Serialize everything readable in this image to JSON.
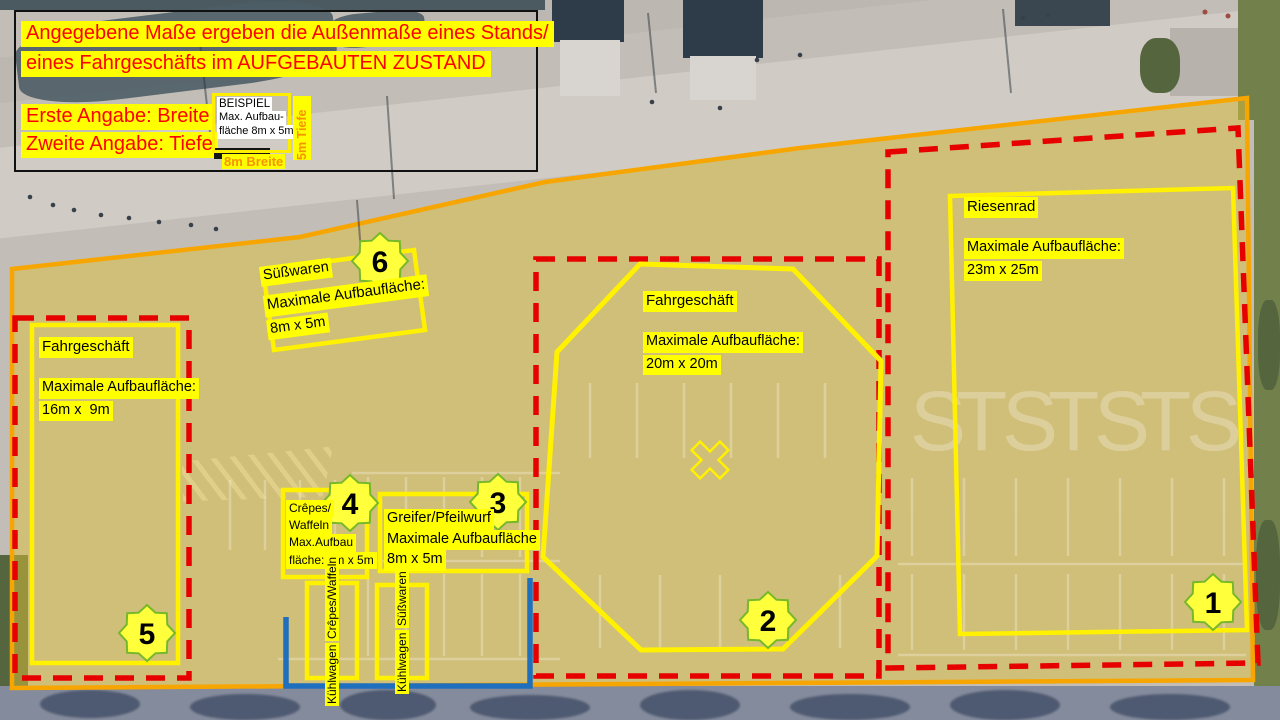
{
  "legend": {
    "title_line1": "Angegebene Maße ergeben die Außenmaße eines Stands/",
    "title_line2": "eines Fahrgeschäfts im AUFGEBAUTEN ZUSTAND",
    "note_breite": "Erste Angabe: Breite",
    "note_tiefe": "Zweite Angabe: Tiefe",
    "example": {
      "title": "BEISPIEL",
      "desc_line1": "Max. Aufbau-",
      "desc_line2": "fläche 8m x 5m",
      "depth_label": "5m Tiefe",
      "width_label": "8m Breite"
    }
  },
  "zones": [
    {
      "badge": "1",
      "name": "Riesenrad",
      "size_label": "Maximale Aufbaufläche:",
      "size": "23m x 25m"
    },
    {
      "badge": "2",
      "name": "Fahrgeschäft",
      "size_label": "Maximale Aufbaufläche:",
      "size": "20m x 20m"
    },
    {
      "badge": "3",
      "name": "Greifer/Pfeilwurf",
      "size_label": "Maximale Aufbaufläche",
      "size": "8m x 5m"
    },
    {
      "badge": "4",
      "name_line1": "Crêpes/",
      "name_line2": "Waffeln",
      "size_label": "Max.Aufbau",
      "size_line2": "fläche: 5m x 5m"
    },
    {
      "badge": "5",
      "name": "Fahrgeschäft",
      "size_label": "Maximale Aufbaufläche:",
      "size": "16m x  9m"
    },
    {
      "badge": "6",
      "name": "Süßwaren",
      "size_label": "Maximale Aufbaufläche:",
      "size": "8m x 5m"
    }
  ],
  "coolers": [
    {
      "line1": "Kühlwagen",
      "line2": "Crêpes/Waffeln"
    },
    {
      "line1": "Kühlwagen",
      "line2": "Süßwaren"
    }
  ],
  "pavement_marks": {
    "letters": [
      "S",
      "T",
      "S",
      "T",
      "S",
      "T",
      "S"
    ]
  },
  "colors": {
    "site_boundary_orange": "#F7A500",
    "restricted_red": "#E60000",
    "marking_yellow": "#FFF100",
    "water_line_blue": "#1E6FBE",
    "badge_fill": "#FFFF3C",
    "badge_stroke": "#76B82A",
    "highlight_yellow": "#FFFF00",
    "legend_text_red": "#FF0000",
    "legend_text_orange": "#F79300"
  }
}
